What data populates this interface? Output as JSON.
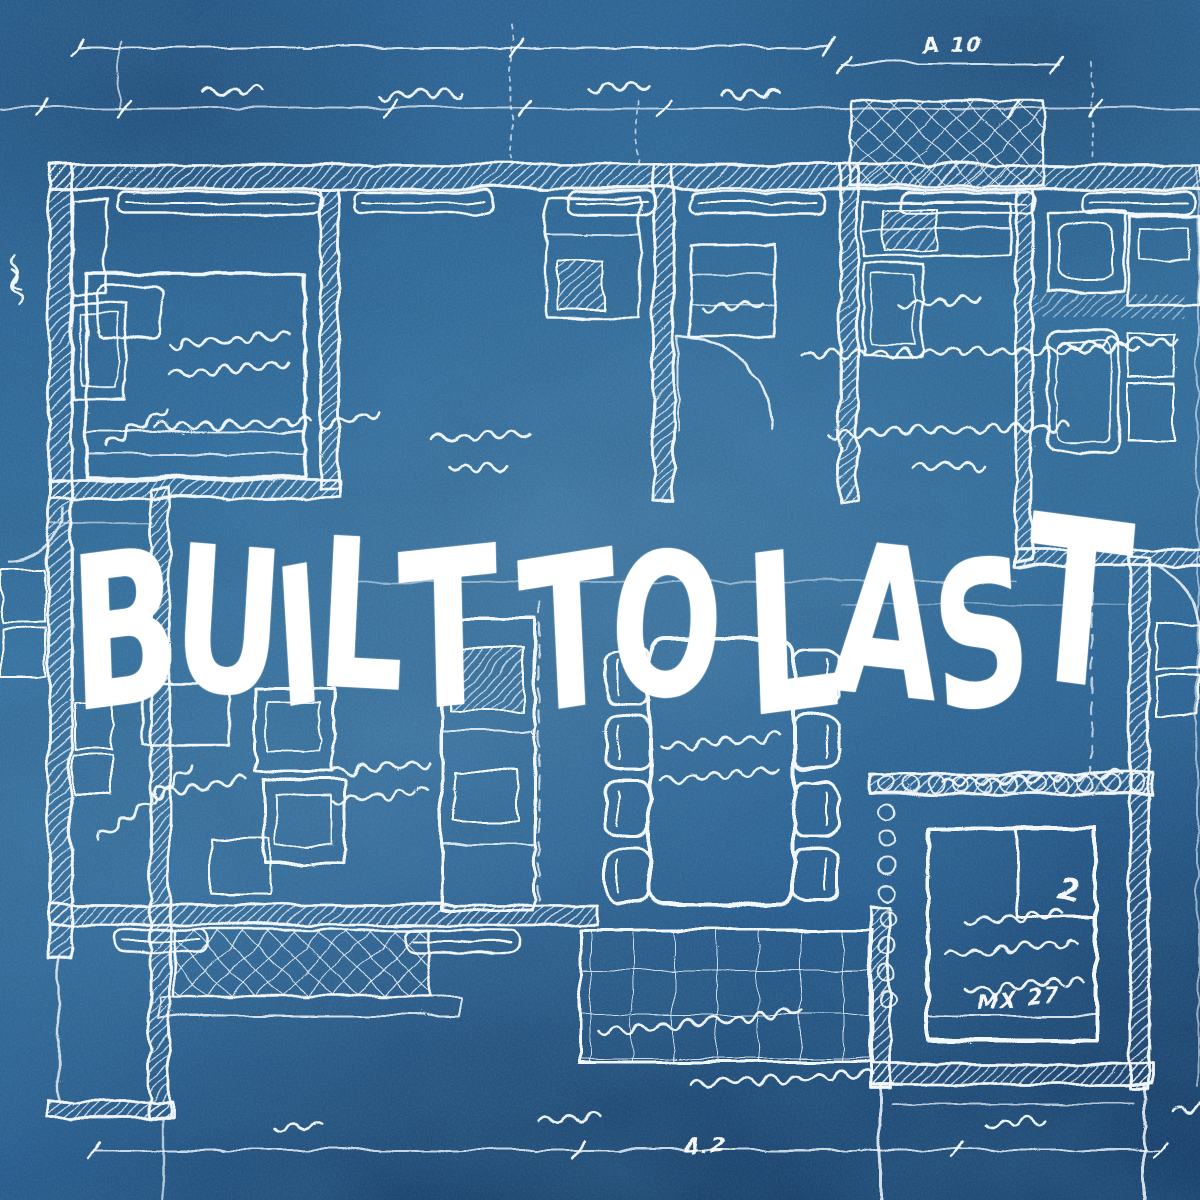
{
  "poster": {
    "title": "BUILT TO LAST",
    "annotations": {
      "dim_top_right": "A 10",
      "bed_note": "MX 27",
      "dim_bottom": "4.2",
      "pillow_mark": "2"
    },
    "colors": {
      "background": "#2f6ba0",
      "background_dark": "#1d4c7c",
      "line": "#ffffff"
    }
  }
}
